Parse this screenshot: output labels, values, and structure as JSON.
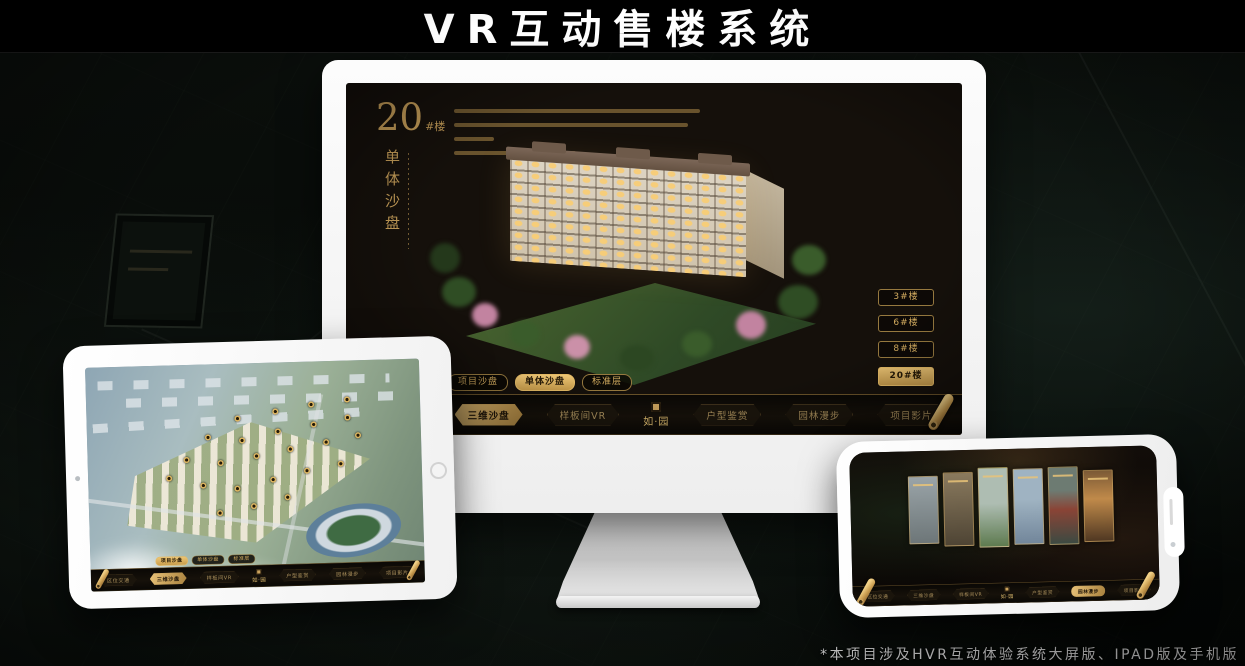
{
  "page": {
    "title": "VR互动售楼系统",
    "footnote": "*本项目涉及HVR互动体验系统大屏版、IPAD版及手机版"
  },
  "colors": {
    "gold": "#cfa95f",
    "gold_selected_bg": "#d8ab5e",
    "screen_bg": "#15100b",
    "page_bg": "#060907"
  },
  "monitor_app": {
    "block_number": "20",
    "block_unit": "#楼",
    "section_title": "单体沙盘",
    "floor_buttons": [
      {
        "label": "3#楼",
        "selected": false
      },
      {
        "label": "6#楼",
        "selected": false
      },
      {
        "label": "8#楼",
        "selected": false
      },
      {
        "label": "20#楼",
        "selected": true
      }
    ],
    "sub_tabs": [
      {
        "label": "项目沙盘",
        "selected": false
      },
      {
        "label": "单体沙盘",
        "selected": true
      },
      {
        "label": "标准层",
        "selected": false
      }
    ],
    "nav_left": [
      {
        "label": "区位交通",
        "selected": false
      },
      {
        "label": "三维沙盘",
        "selected": true
      },
      {
        "label": "样板间VR",
        "selected": false
      }
    ],
    "nav_right": [
      {
        "label": "户型鉴赏",
        "selected": false
      },
      {
        "label": "园林漫步",
        "selected": false
      },
      {
        "label": "项目影片",
        "selected": false
      }
    ],
    "logo": "如·园"
  },
  "ipad_app": {
    "sub_tabs": [
      {
        "label": "项目沙盘",
        "selected": true
      },
      {
        "label": "单体沙盘",
        "selected": false
      },
      {
        "label": "标准层",
        "selected": false
      }
    ],
    "nav_left": [
      {
        "label": "区位交通",
        "selected": false
      },
      {
        "label": "三维沙盘",
        "selected": true
      },
      {
        "label": "样板间VR",
        "selected": false
      }
    ],
    "nav_right": [
      {
        "label": "户型鉴赏",
        "selected": false
      },
      {
        "label": "园林漫步",
        "selected": false
      },
      {
        "label": "项目影片",
        "selected": false
      }
    ],
    "logo": "如·园"
  },
  "phone_app": {
    "nav_left": [
      {
        "label": "区位交通",
        "selected": false
      },
      {
        "label": "三维沙盘",
        "selected": false
      },
      {
        "label": "样板间VR",
        "selected": false
      }
    ],
    "nav_right": [
      {
        "label": "户型鉴赏",
        "selected": false
      },
      {
        "label": "园林漫步",
        "selected": true
      },
      {
        "label": "项目影片",
        "selected": false
      }
    ],
    "logo": "如·园"
  }
}
